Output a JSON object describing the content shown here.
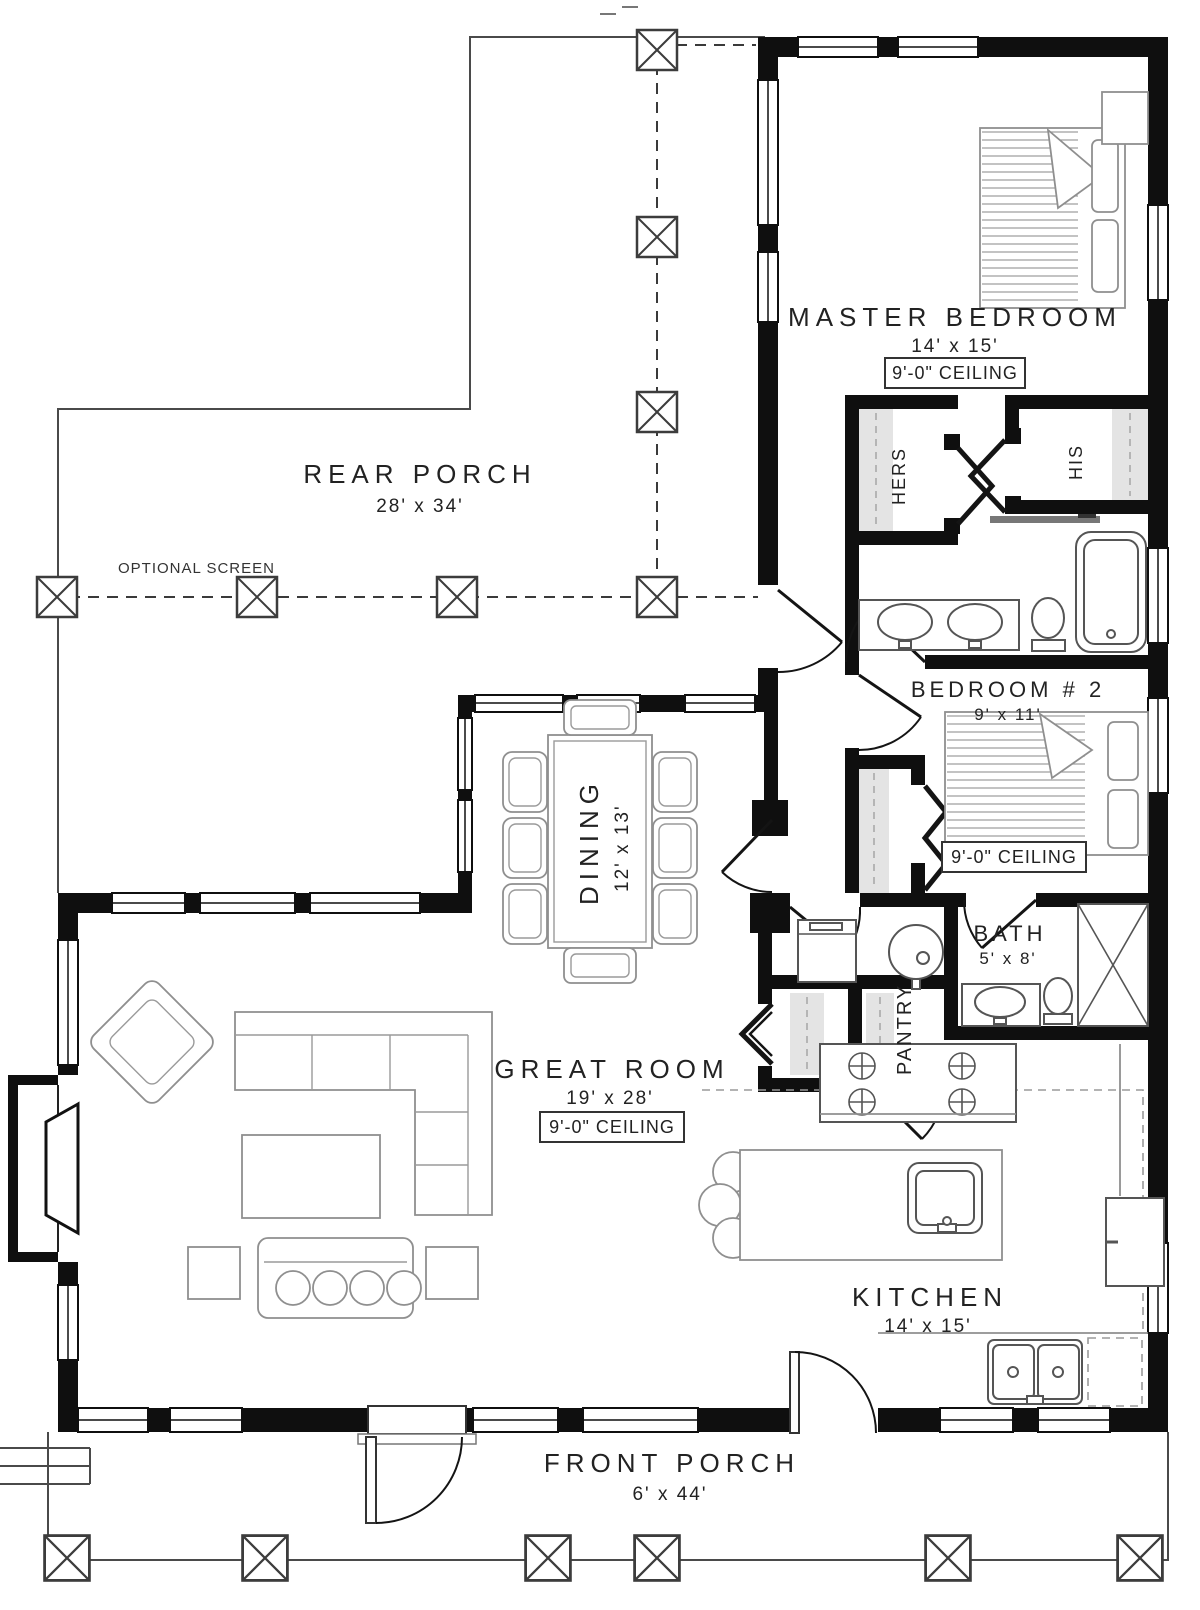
{
  "rooms": {
    "rear_porch": {
      "name": "REAR PORCH",
      "dims": "28' x 34'"
    },
    "master_bedroom": {
      "name": "MASTER BEDROOM",
      "dims": "14' x 15'",
      "ceiling": "9'-0\" CEILING"
    },
    "hers": {
      "name": "HERS"
    },
    "his": {
      "name": "HIS"
    },
    "bedroom2": {
      "name": "BEDROOM # 2",
      "dims": "9' x 11'",
      "ceiling": "9'-0\" CEILING"
    },
    "dining": {
      "name": "DINING",
      "dims": "12' x 13'"
    },
    "bath": {
      "name": "BATH",
      "dims": "5' x 8'"
    },
    "pantry": {
      "name": "PANTRY"
    },
    "great_room": {
      "name": "GREAT ROOM",
      "dims": "19' x 28'",
      "ceiling": "9'-0\" CEILING"
    },
    "kitchen": {
      "name": "KITCHEN",
      "dims": "14' x 15'"
    },
    "front_porch": {
      "name": "FRONT PORCH",
      "dims": "6' x 44'"
    }
  },
  "annotations": {
    "optional_screen": "OPTIONAL SCREEN"
  },
  "colors": {
    "wall": "#0f0f0f",
    "background": "#ffffff",
    "shelf": "#e4e4e4"
  }
}
